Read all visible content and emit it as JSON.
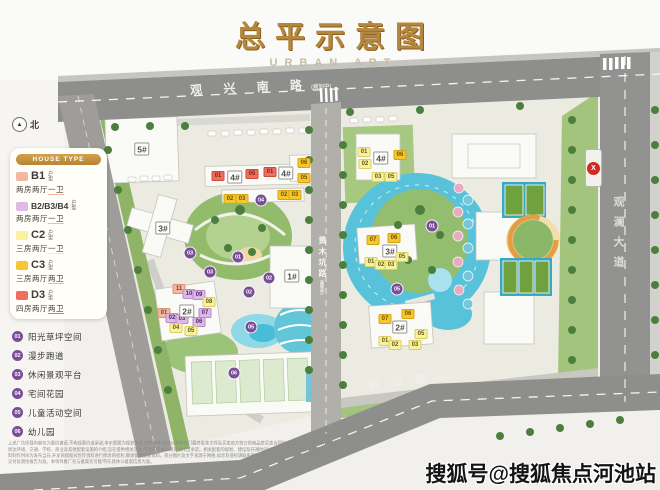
{
  "title": {
    "main": "总平示意图",
    "sub": "URBAN ART"
  },
  "north": {
    "arrow": "▲",
    "label": "北"
  },
  "legend": {
    "header": "HOUSE TYPE",
    "items": [
      {
        "code": "B1",
        "suffix": "户型",
        "desc_main": "两房两厅",
        "desc_end": "一卫",
        "color": "#f4b8a0"
      },
      {
        "code": "B2/B3/B4",
        "suffix": "户型",
        "desc_main": "两房两厅",
        "desc_end": "一卫",
        "color": "#dcb9e6"
      },
      {
        "code": "C2",
        "suffix": "户型",
        "desc_main": "三房两厅",
        "desc_end": "一卫",
        "color": "#f8f1a0"
      },
      {
        "code": "C3",
        "suffix": "户型",
        "desc_main": "三房两厅",
        "desc_end": "两卫",
        "color": "#f6c62e"
      },
      {
        "code": "D3",
        "suffix": "户型",
        "desc_main": "四房两厅",
        "desc_end": "两卫",
        "color": "#ef6e5e"
      }
    ]
  },
  "amenities": [
    {
      "num": "01",
      "label": "阳光草坪空间"
    },
    {
      "num": "02",
      "label": "漫步跑道"
    },
    {
      "num": "03",
      "label": "休闲景观平台"
    },
    {
      "num": "04",
      "label": "宅间花园"
    },
    {
      "num": "05",
      "label": "儿童活动空间"
    },
    {
      "num": "06",
      "label": "幼儿园"
    }
  ],
  "roads": {
    "top": {
      "name": "观 兴 南 路",
      "note": "(规划中)"
    },
    "right": {
      "name": "观澜大道",
      "note": ""
    },
    "middle": {
      "name": "黄木坑路",
      "note": "(规划中)"
    },
    "bottom": {
      "name": "茜 田 路",
      "note": "(规划中)"
    }
  },
  "station": {
    "symbol": "X"
  },
  "watermark": "搜狐号@搜狐焦点河池站",
  "fine_print": "上述广告所载内容仅为要约邀请,不构成要约或承诺;本示意图为规划示意,仅供参考,具体以政府部门最终批准文件及买卖双方签订的商品房买卖合同约定为准。本宣传资料对项目周边环境、交通、学校、商业及其他配套设施的介绍,旨在提供相关信息,不意味着本公司对此作出承诺。相关配套的规划、建设及开通时间以政府部门公示为准,敬请留意。本资料制作时间为发布当日,开发商保留对宣传资料进行修改的权利,敬请留意最新资料。部分图片及文字来源于网络,如涉及侵权请联系删除。户型图、面积均为建筑面积,最终以实际交付及测绘报告为准。本项目推广名与备案名可能不同,具体以备案信息为准。",
  "marker_types": {
    "d3": {
      "bg": "#ef6e5e",
      "text": "#7e1f12",
      "border": "#d14a38"
    },
    "c3": {
      "bg": "#f6c62e",
      "text": "#6d5200",
      "border": "#d7a410"
    },
    "c2": {
      "bg": "#f8f1a0",
      "text": "#5f5a10",
      "border": "#d9cf62"
    },
    "b1": {
      "bg": "#f4b8a0",
      "text": "#7e3c22",
      "border": "#da9377"
    },
    "b234": {
      "bg": "#dcb9e6",
      "text": "#55266e",
      "border": "#b98cc8"
    },
    "bld": {
      "bg": "#ffffff",
      "text": "#4c4c48",
      "border": "#97968f"
    },
    "amen": {
      "bg": "#7a4d99",
      "text": "#ffffff",
      "border": "#ffffff"
    }
  },
  "map_markers": [
    {
      "t": "bld",
      "label": "5#",
      "x": 142,
      "y": 149
    },
    {
      "t": "d3",
      "label": "01",
      "x": 218,
      "y": 176
    },
    {
      "t": "bld",
      "label": "4#",
      "x": 235,
      "y": 177
    },
    {
      "t": "d3",
      "label": "05",
      "x": 252,
      "y": 174
    },
    {
      "t": "d3",
      "label": "01",
      "x": 270,
      "y": 172
    },
    {
      "t": "bld",
      "label": "4#",
      "x": 286,
      "y": 173
    },
    {
      "t": "c3",
      "label": "06",
      "x": 304,
      "y": 163
    },
    {
      "t": "c3",
      "label": "05",
      "x": 304,
      "y": 178
    },
    {
      "t": "c3",
      "label": "02",
      "x": 230,
      "y": 199
    },
    {
      "t": "c3",
      "label": "03",
      "x": 242,
      "y": 199
    },
    {
      "t": "c3",
      "label": "02",
      "x": 284,
      "y": 195
    },
    {
      "t": "c3",
      "label": "03",
      "x": 295,
      "y": 195
    },
    {
      "t": "bld",
      "label": "3#",
      "x": 163,
      "y": 228
    },
    {
      "t": "bld",
      "label": "1#",
      "x": 292,
      "y": 276
    },
    {
      "t": "b1",
      "label": "11",
      "x": 179,
      "y": 289
    },
    {
      "t": "b234",
      "label": "10",
      "x": 189,
      "y": 294
    },
    {
      "t": "b234",
      "label": "09",
      "x": 199,
      "y": 295
    },
    {
      "t": "c2",
      "label": "08",
      "x": 209,
      "y": 302
    },
    {
      "t": "b1",
      "label": "01",
      "x": 164,
      "y": 313
    },
    {
      "t": "b234",
      "label": "02",
      "x": 172,
      "y": 318
    },
    {
      "t": "b234",
      "label": "03",
      "x": 182,
      "y": 319
    },
    {
      "t": "b234",
      "label": "07",
      "x": 205,
      "y": 313
    },
    {
      "t": "b234",
      "label": "06",
      "x": 199,
      "y": 322
    },
    {
      "t": "c2",
      "label": "04",
      "x": 176,
      "y": 328
    },
    {
      "t": "c2",
      "label": "05",
      "x": 191,
      "y": 331
    },
    {
      "t": "bld",
      "label": "2#",
      "x": 187,
      "y": 311
    },
    {
      "t": "c2",
      "label": "01",
      "x": 364,
      "y": 152
    },
    {
      "t": "c2",
      "label": "02",
      "x": 365,
      "y": 164
    },
    {
      "t": "bld",
      "label": "4#",
      "x": 381,
      "y": 158
    },
    {
      "t": "c3",
      "label": "06",
      "x": 400,
      "y": 155
    },
    {
      "t": "c2",
      "label": "03",
      "x": 378,
      "y": 177
    },
    {
      "t": "c2",
      "label": "05",
      "x": 391,
      "y": 177
    },
    {
      "t": "c3",
      "label": "07",
      "x": 373,
      "y": 240
    },
    {
      "t": "bld",
      "label": "3#",
      "x": 390,
      "y": 251
    },
    {
      "t": "c3",
      "label": "06",
      "x": 394,
      "y": 238
    },
    {
      "t": "c2",
      "label": "01",
      "x": 371,
      "y": 262
    },
    {
      "t": "c2",
      "label": "02",
      "x": 381,
      "y": 265
    },
    {
      "t": "c2",
      "label": "03",
      "x": 391,
      "y": 265
    },
    {
      "t": "c2",
      "label": "05",
      "x": 402,
      "y": 257
    },
    {
      "t": "c3",
      "label": "07",
      "x": 385,
      "y": 319
    },
    {
      "t": "c3",
      "label": "06",
      "x": 408,
      "y": 314
    },
    {
      "t": "bld",
      "label": "2#",
      "x": 400,
      "y": 327
    },
    {
      "t": "c2",
      "label": "05",
      "x": 421,
      "y": 334
    },
    {
      "t": "c2",
      "label": "01",
      "x": 385,
      "y": 341
    },
    {
      "t": "c2",
      "label": "02",
      "x": 395,
      "y": 345
    },
    {
      "t": "c2",
      "label": "03",
      "x": 415,
      "y": 345
    },
    {
      "t": "amen",
      "label": "04",
      "x": 261,
      "y": 200
    },
    {
      "t": "amen",
      "label": "03",
      "x": 190,
      "y": 253
    },
    {
      "t": "amen",
      "label": "01",
      "x": 238,
      "y": 257
    },
    {
      "t": "amen",
      "label": "03",
      "x": 210,
      "y": 272
    },
    {
      "t": "amen",
      "label": "02",
      "x": 269,
      "y": 278
    },
    {
      "t": "amen",
      "label": "02",
      "x": 249,
      "y": 292
    },
    {
      "t": "amen",
      "label": "05",
      "x": 251,
      "y": 327
    },
    {
      "t": "amen",
      "label": "06",
      "x": 234,
      "y": 373
    },
    {
      "t": "amen",
      "label": "05",
      "x": 397,
      "y": 289
    },
    {
      "t": "amen",
      "label": "01",
      "x": 432,
      "y": 226
    }
  ]
}
